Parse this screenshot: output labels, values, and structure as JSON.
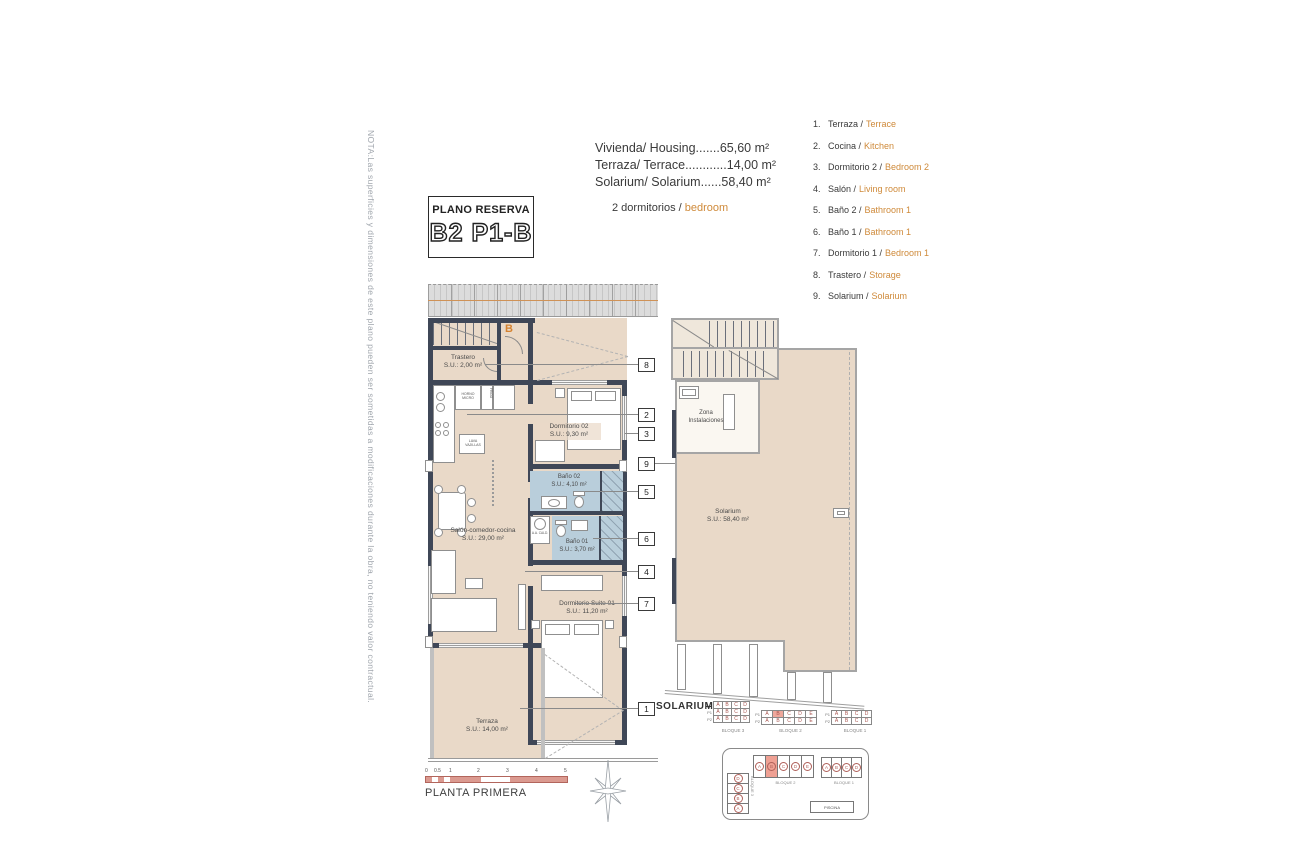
{
  "note": "NOTA:Las superficies y dimensiones de este plano pueden ser sometidas a modificaciones durante la obra, no teniendo valor contractual.",
  "title_box": {
    "label": "PLANO RESERVA",
    "unit": "B2 P1-B"
  },
  "summary": {
    "line1": "Vivienda/ Housing.......65,60 m²",
    "line2": "Terraza/ Terrace............14,00 m²",
    "line3": "Solarium/ Solarium......58,40 m²",
    "bedrooms_es": "2 dormitorios /",
    "bedrooms_en": "bedroom"
  },
  "legend": {
    "items": [
      {
        "num": "1.",
        "es": "Terraza /",
        "en": "Terrace"
      },
      {
        "num": "2.",
        "es": "Cocina /",
        "en": "Kitchen"
      },
      {
        "num": "3.",
        "es": "Dormitorio 2 /",
        "en": "Bedroom 2"
      },
      {
        "num": "4.",
        "es": "Salón /",
        "en": "Living room"
      },
      {
        "num": "5.",
        "es": "Baño 2 /",
        "en": "Bathroom 1"
      },
      {
        "num": "6.",
        "es": "Baño 1 /",
        "en": "Bathroom 1"
      },
      {
        "num": "7.",
        "es": "Dormitorio 1 /",
        "en": "Bedroom 1"
      },
      {
        "num": "8.",
        "es": "Trastero /",
        "en": "Storage"
      },
      {
        "num": "9.",
        "es": "Solarium /",
        "en": "Solarium"
      }
    ]
  },
  "plan": {
    "entry_letter": "B",
    "trastero_name": "Trastero",
    "trastero_area": "S.U.: 2,00 m²",
    "dorm2_name": "Dormitorio 02",
    "dorm2_area": "S.U.: 9,30 m²",
    "bath2_name": "Baño 02",
    "bath2_area": "S.U.: 4,10 m²",
    "bath1_name": "Baño 01",
    "bath1_area": "S.U.: 3,70 m²",
    "salon_name": "Salón-comedor-cocina",
    "salon_area": "S.U.: 29,00 m²",
    "suite_name": "Dormitorio Suite 01",
    "suite_area": "S.U.: 11,20 m²",
    "terraza_name": "Terraza",
    "terraza_area": "S.U.: 14,00 m²",
    "kitchen_labels": {
      "horno": "HORNO MICRO",
      "frigo": "FRIGO",
      "lava": "LAVA VAJILLAS",
      "caldera": "A.A. CALD."
    }
  },
  "plan_right": {
    "zona_line1": "Zona",
    "zona_line2": "Instalaciones",
    "solarium_name": "Solarium",
    "solarium_area": "S.U.: 58,40 m²"
  },
  "callouts": [
    "8",
    "2",
    "3",
    "9",
    "5",
    "6",
    "4",
    "7",
    "1"
  ],
  "solarium_key": {
    "label": "SOLARIUM",
    "row_labels": [
      "P1",
      "P2"
    ],
    "bloque3": {
      "name": "BLOQUE 3",
      "rows": [
        [
          "A",
          "B",
          "C",
          "D"
        ],
        [
          "A",
          "B",
          "C",
          "D"
        ],
        [
          "A",
          "B",
          "C",
          "D"
        ]
      ]
    },
    "bloque2": {
      "name": "BLOQUE 2",
      "rows": [
        [
          "A",
          "B",
          "C",
          "D",
          "E"
        ],
        [
          "A",
          "B",
          "C",
          "D",
          "E"
        ]
      ],
      "highlight": "B"
    },
    "bloque1": {
      "name": "BLOQUE 1",
      "rows": [
        [
          "A",
          "B",
          "C",
          "D"
        ],
        [
          "A",
          "B",
          "C",
          "D"
        ]
      ]
    }
  },
  "site_plan": {
    "bloque3": {
      "name": "BLOQUE 3",
      "units": [
        "D",
        "C",
        "B",
        "A"
      ]
    },
    "bloque2": {
      "name": "BLOQUE 2",
      "units": [
        "A",
        "B",
        "C",
        "D",
        "E"
      ],
      "highlight": "B"
    },
    "bloque1": {
      "name": "BLOQUE 1",
      "units": [
        "A",
        "B",
        "C",
        "D"
      ]
    },
    "pool": "PISCINA"
  },
  "scale": {
    "ticks": [
      "0",
      "0.5",
      "1",
      "2",
      "3",
      "4",
      "5"
    ],
    "label": "PLANTA PRIMERA"
  }
}
